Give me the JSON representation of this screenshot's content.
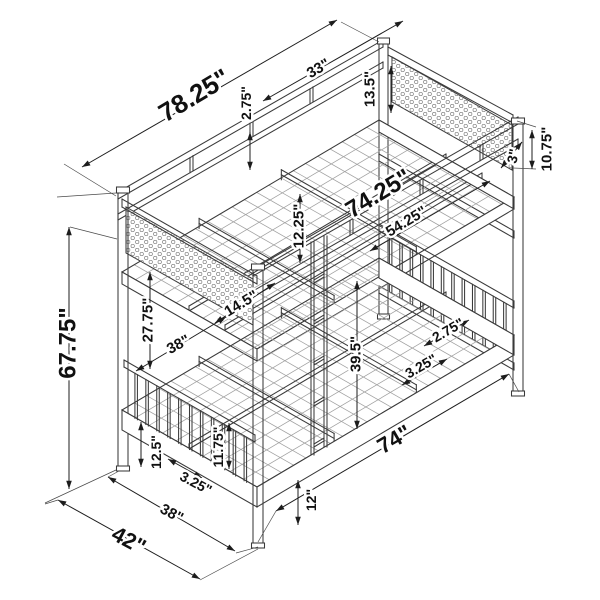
{
  "diagram": {
    "background": "#ffffff",
    "colors": {
      "structure": "#3a3a3a",
      "mesh": "#a0a0a0",
      "dimension": "#1c1c1c",
      "text": "#111111",
      "honeycomb": "#808080"
    },
    "dimensions": [
      {
        "name": "dim-78-25",
        "text": "78.25\"",
        "x": 194,
        "y": 95,
        "rotate": -31,
        "size": 26,
        "line": [
          82,
          167,
          337,
          20
        ]
      },
      {
        "name": "dim-33",
        "text": "33\"",
        "x": 318,
        "y": 68,
        "rotate": -30,
        "size": 15,
        "line": [
          263,
          101,
          403,
          21
        ]
      },
      {
        "name": "dim-2-75-top",
        "text": "2.75\"",
        "x": 246,
        "y": 103,
        "rotate": -90,
        "size": 14,
        "line": [
          250,
          132,
          250,
          170
        ]
      },
      {
        "name": "dim-13-5",
        "text": "13.5\"",
        "x": 369,
        "y": 89,
        "rotate": -90,
        "size": 15,
        "line": [
          391,
          66,
          391,
          113
        ]
      },
      {
        "name": "dim-10-75",
        "text": "10.75\"",
        "x": 546,
        "y": 149,
        "rotate": -90,
        "size": 15,
        "line": [
          532,
          130,
          532,
          169
        ]
      },
      {
        "name": "dim-3",
        "text": "3\"",
        "x": 513,
        "y": 156,
        "rotate": -78,
        "size": 14,
        "line": [
          501,
          168,
          522,
          142
        ]
      },
      {
        "name": "dim-74-25",
        "text": "74.25\"",
        "x": 378,
        "y": 193,
        "rotate": -31,
        "size": 24,
        "line": null
      },
      {
        "name": "dim-54-25",
        "text": "54.25\"",
        "x": 406,
        "y": 221,
        "rotate": -31,
        "size": 15,
        "line": [
          370,
          251,
          490,
          181
        ]
      },
      {
        "name": "dim-12-25",
        "text": "12.25\"",
        "x": 298,
        "y": 226,
        "rotate": -90,
        "size": 15,
        "line": [
          300,
          194,
          300,
          263
        ]
      },
      {
        "name": "dim-14-5",
        "text": "14.5\"",
        "x": 241,
        "y": 303,
        "rotate": -31,
        "size": 15,
        "line": [
          215,
          323,
          275,
          283
        ]
      },
      {
        "name": "dim-27-75",
        "text": "27.75\"",
        "x": 147,
        "y": 320,
        "rotate": -90,
        "size": 15,
        "line": [
          150,
          272,
          150,
          369
        ]
      },
      {
        "name": "dim-38-upper",
        "text": "38\"",
        "x": 178,
        "y": 344,
        "rotate": -28,
        "size": 15,
        "line": [
          136,
          371,
          226,
          317
        ]
      },
      {
        "name": "dim-39-5",
        "text": "39.5\"",
        "x": 355,
        "y": 354,
        "rotate": -90,
        "size": 15,
        "line": [
          357,
          281,
          357,
          429
        ]
      },
      {
        "name": "dim-2-75-lower",
        "text": "2.75\"",
        "x": 448,
        "y": 330,
        "rotate": -30,
        "size": 14,
        "line": [
          424,
          346,
          469,
          320
        ]
      },
      {
        "name": "dim-3-25-right",
        "text": "3.25\"",
        "x": 421,
        "y": 366,
        "rotate": -30,
        "size": 14,
        "line": [
          402,
          385,
          447,
          359
        ]
      },
      {
        "name": "dim-74",
        "text": "74\"",
        "x": 394,
        "y": 439,
        "rotate": -30,
        "size": 22,
        "line": [
          276,
          511,
          509,
          374
        ]
      },
      {
        "name": "dim-12",
        "text": "12\"",
        "x": 311,
        "y": 500,
        "rotate": -90,
        "size": 14,
        "line": [
          298,
          480,
          298,
          525
        ]
      },
      {
        "name": "dim-12-5",
        "text": "12.5\"",
        "x": 156,
        "y": 452,
        "rotate": -90,
        "size": 14,
        "line": [
          141,
          422,
          141,
          467
        ]
      },
      {
        "name": "dim-11-75",
        "text": "11.75\"",
        "x": 218,
        "y": 447,
        "rotate": -90,
        "size": 14,
        "line": [
          229,
          423,
          229,
          469
        ]
      },
      {
        "name": "dim-3-25-left",
        "text": "3.25\"",
        "x": 196,
        "y": 483,
        "rotate": 28,
        "size": 14,
        "line": [
          168,
          459,
          202,
          478
        ]
      },
      {
        "name": "dim-38-bottom",
        "text": "38\"",
        "x": 172,
        "y": 513,
        "rotate": 28,
        "size": 15,
        "line": [
          108,
          477,
          235,
          551
        ]
      },
      {
        "name": "dim-42",
        "text": "42\"",
        "x": 129,
        "y": 540,
        "rotate": 28,
        "size": 22,
        "line": [
          58,
          500,
          200,
          579
        ]
      },
      {
        "name": "dim-67-75",
        "text": "67.75\"",
        "x": 67,
        "y": 343,
        "rotate": -90,
        "size": 24,
        "line": [
          69,
          227,
          69,
          489
        ]
      }
    ]
  }
}
